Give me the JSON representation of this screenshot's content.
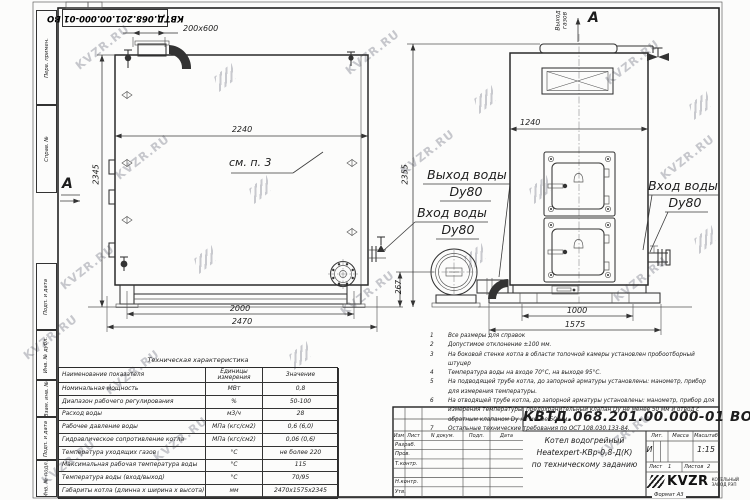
{
  "watermark": {
    "text": "KVZR.RU"
  },
  "frame": {
    "stamp_top_number": "КВТД.068.201.00.000-01 ВО",
    "margin_labels": [
      "Перв. примен.",
      "Справ. №",
      "Подп. и дата",
      "Инв. № дубл.",
      "Взам. инв. №",
      "Подп. и дата",
      "Инв. № подл."
    ],
    "format_note": "Формат  А3"
  },
  "left_view": {
    "section_label": "А",
    "callout_note": "см. п. 3",
    "dims": {
      "duct": "200x600",
      "shell_length": "2240",
      "height": "2345",
      "legs_span": "2000",
      "total_length": "2470",
      "axis_height": "267"
    }
  },
  "right_view": {
    "view_label": "А",
    "gas_outlet": "Выход газов",
    "dims": {
      "width": "1240",
      "total_height": "2355",
      "legs_span": "1000",
      "base_width": "1575"
    },
    "inlet_label": {
      "line1": "Вход воды",
      "line2": "Dy80"
    }
  },
  "pipe_labels": {
    "outlet": {
      "line1": "Выход воды",
      "line2": "Dy80"
    },
    "inlet": {
      "line1": "Вход воды",
      "line2": "Dy80"
    }
  },
  "notes": [
    {
      "n": "1",
      "text": "Все размеры для справок"
    },
    {
      "n": "2",
      "text": "Допустимое отклонение  ±100 мм."
    },
    {
      "n": "3",
      "text": "На боковой стенке котла в области топочной камеры установлен пробоотборный штуцер"
    },
    {
      "n": "4",
      "text": "Температура воды на входе  70°С, на выходе  95°С."
    },
    {
      "n": "5",
      "text": "На  подводящей трубе котла, до запорной арматуры установлены: манометр, прибор для измерения температуры."
    },
    {
      "n": "6",
      "text": "На отводящей трубе котла, до запорной арматуры установлены: манометр, прибор для измерения температуры, предохранительный клапан  Dу не менее  50 мм и отвод с обратным клапаном  Dу не менее  50 мм."
    },
    {
      "n": "7",
      "text": "Остальные технические требования по ОСТ  108.030.133-84."
    }
  ],
  "tech_table": {
    "title": "Техническая характеристика",
    "headers": [
      "Наименование показателя",
      "Единицы измерения",
      "Значение"
    ],
    "rows": [
      [
        "Номинальная мощность",
        "МВт",
        "0,8"
      ],
      [
        "Диапазон рабочего регулирования",
        "%",
        "50-100"
      ],
      [
        "Расход воды",
        "м3/ч",
        "28"
      ],
      [
        "Рабочее давление воды",
        "МПа (кгс/см2)",
        "0,6 (6,0)"
      ],
      [
        "Гидравлическое сопротивление котла",
        "МПа (кгс/см2)",
        "0,06 (0,6)"
      ],
      [
        "Температура уходящих газов",
        "°С",
        "не более 220"
      ],
      [
        "Максимальная рабочая температура воды",
        "°С",
        "115"
      ],
      [
        "Температура воды (вход/выход)",
        "°С",
        "70/95"
      ],
      [
        "Габариты котла (длинна х ширина х высота)",
        "мм",
        "2470х1575х2345"
      ]
    ]
  },
  "title_block": {
    "doc_number": "КВТД.068.201.00.000-01  ВО",
    "product_line1": "Котел водогрейный",
    "product_line2": "Heatexpert-КВр-0,8-Д(К)",
    "product_line3": "по техническому заданию",
    "header_cols": [
      "Изм",
      "Лист",
      "N докум.",
      "Подп.",
      "Дата"
    ],
    "row_labels": [
      "Разраб.",
      "Пров.",
      "Т.контр.",
      "",
      "Н.контр.",
      "Утв."
    ],
    "lit_header": "Лит.",
    "mass_header": "Масса",
    "scale_header": "Масштаб",
    "lit_value": "И",
    "scale_value": "1:15",
    "sheet_label": "Лист",
    "sheet_value": "1",
    "sheets_label": "Листов",
    "sheets_value": "2",
    "logo_text": "KVZR",
    "logo_sub1": "КОТЕЛЬНЫЙ",
    "logo_sub2": "ЗАВОД РЭП"
  }
}
